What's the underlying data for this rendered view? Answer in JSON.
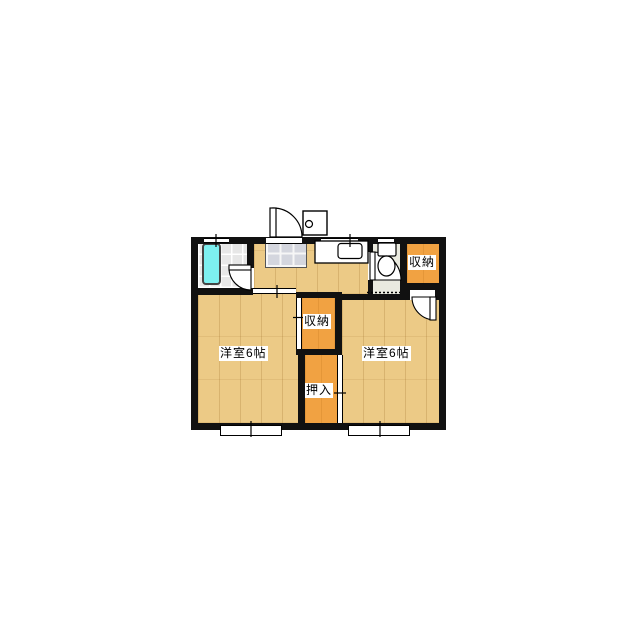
{
  "floorplan": {
    "title": "2K apartment floor plan",
    "labels": {
      "room_left": "洋室6帖",
      "room_right": "洋室6帖",
      "storage_mid": "収納",
      "storage_topright": "収納",
      "oshiire": "押入"
    },
    "colors": {
      "wall": "#111111",
      "wood_floor": "#ECCA86",
      "closet_orange": "#F1A242",
      "bathtub_cyan": "#7DF0F0",
      "bath_tile": "#E7E7E7",
      "toilet_floor": "#EAEADF",
      "kitchen_tile": "#D4D6DE"
    },
    "fixtures": [
      "bathtub",
      "bath-door",
      "kitchen-tile-panel",
      "kitchen-counter",
      "kitchen-sink",
      "toilet",
      "toilet-door",
      "entrance-door",
      "water-heater",
      "storage-door",
      "window-top-bath",
      "window-top-kitchen",
      "window-top-toilet",
      "window-bottom-left-room",
      "window-bottom-right-room"
    ]
  }
}
